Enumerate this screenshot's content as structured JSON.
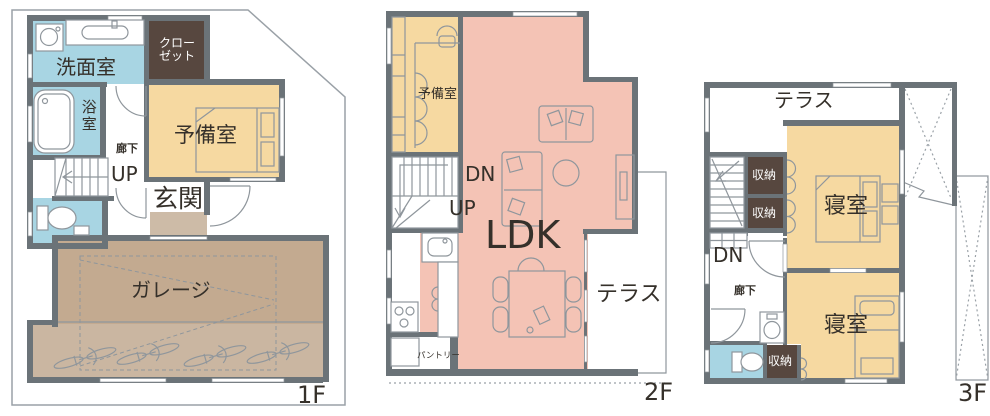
{
  "colors": {
    "wall": "#6b7378",
    "water": "#a8d5e3",
    "tan": "#f6d9a1",
    "pink": "#f4c3b5",
    "garage": "#c3aa90",
    "garage_light": "#cab6a1",
    "dark_closet": "#57473f",
    "step": "#cdbba7",
    "line": "#8f969c",
    "site": "#9aa1a7",
    "text": "#35302a"
  },
  "floor1": {
    "floor_label": "1F",
    "washroom": "洗面室",
    "closet_line1": "クロー",
    "closet_line2": "ゼット",
    "bath": "浴室",
    "spare_room": "予備室",
    "hallway": "廊下",
    "stairs_up": "UP",
    "entrance": "玄関",
    "garage": "ガレージ"
  },
  "floor2": {
    "floor_label": "2F",
    "spare_room": "予備室",
    "stairs_down": "DN",
    "stairs_up": "UP",
    "ldk": "LDK",
    "terrace": "テラス",
    "pantry": "パントリー"
  },
  "floor3": {
    "floor_label": "3F",
    "terrace": "テラス",
    "storage_upper1": "収納",
    "storage_upper2": "収納",
    "bedroom1": "寝室",
    "stairs_down": "DN",
    "hallway": "廊下",
    "storage_lower": "収納",
    "bedroom2": "寝室"
  }
}
